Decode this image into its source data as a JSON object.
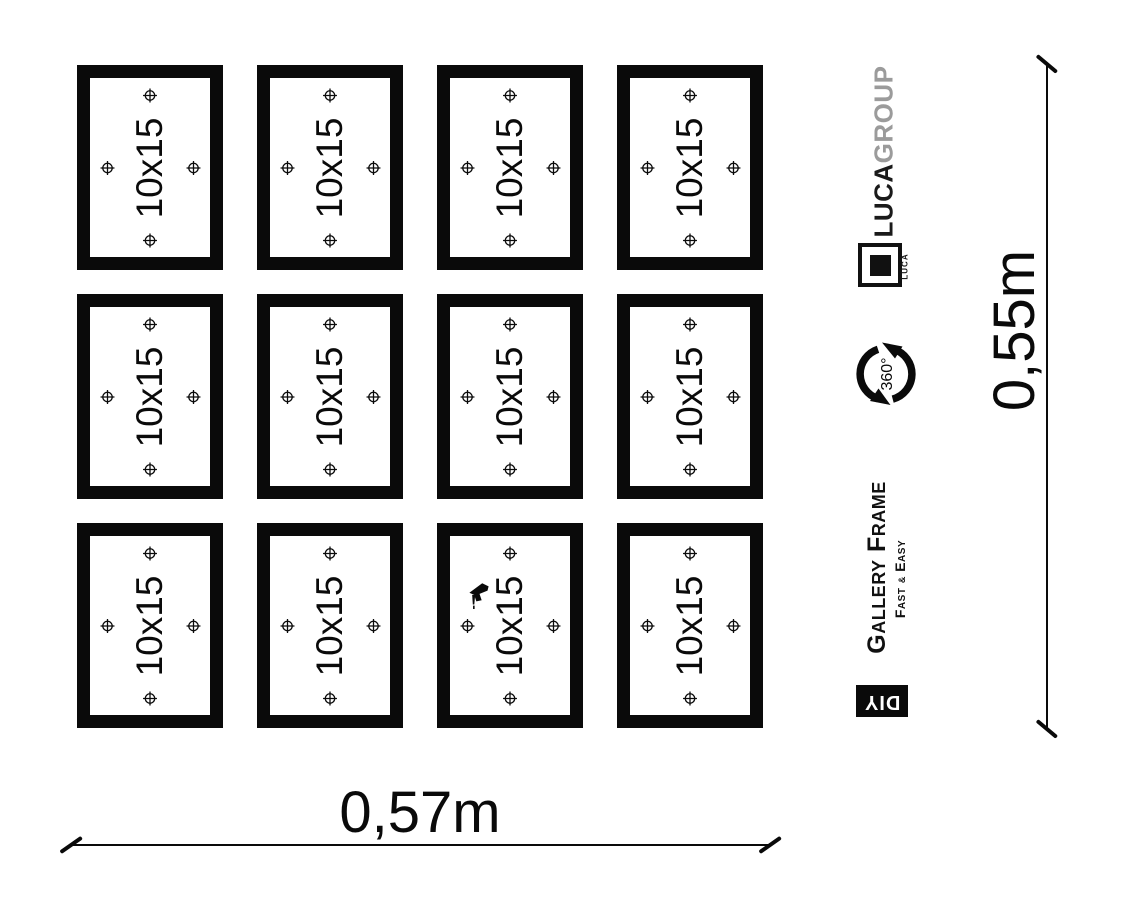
{
  "colors": {
    "ink": "#0a0a0a",
    "gray_text": "#9b9b9b",
    "background": "#ffffff"
  },
  "frames": {
    "label": "10x15",
    "rows": 3,
    "cols": 4,
    "count": 12,
    "mounting_points_per_frame": 4,
    "drill_icon_cell": {
      "row": 3,
      "col": 3
    }
  },
  "dimensions": {
    "width_label": "0,57m",
    "height_label": "0,55m"
  },
  "branding": {
    "company_bold": "LUCA",
    "company_light": "GROUP",
    "logo_caption": "LUCA",
    "rotation_badge": "360°",
    "product_title": "Gallery Frame",
    "product_subtitle_pre": "Fast ",
    "product_subtitle_amp": "&",
    "product_subtitle_post": " Easy",
    "diy_badge": "DIY"
  }
}
